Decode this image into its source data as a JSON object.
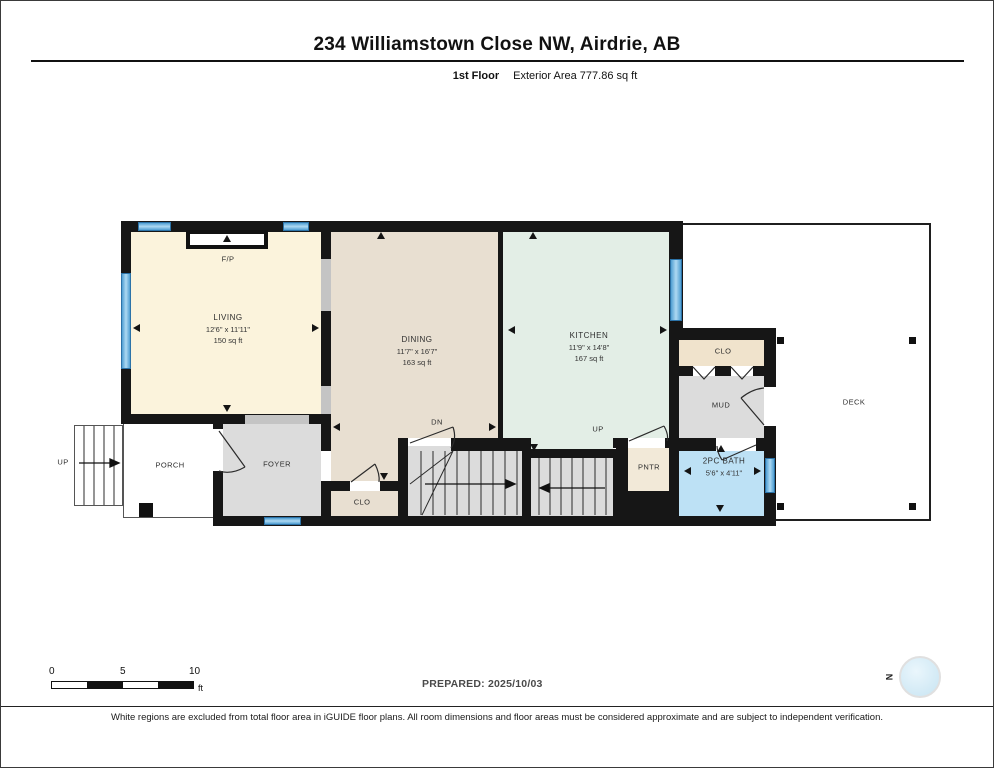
{
  "header": {
    "title": "234 Williamstown Close NW, Airdrie, AB",
    "floor_label": "1st Floor",
    "area_label": "Exterior Area 777.86 sq ft"
  },
  "rooms": {
    "living": {
      "name": "LIVING",
      "dims": "12'6\" x 11'11\"",
      "area": "150 sq ft"
    },
    "dining": {
      "name": "DINING",
      "dims": "11'7\" x 16'7\"",
      "area": "163 sq ft"
    },
    "kitchen": {
      "name": "KITCHEN",
      "dims": "11'9\" x 14'8\"",
      "area": "167 sq ft"
    },
    "bath": {
      "name": "2PC BATH",
      "dims": "5'6\" x 4'11\""
    },
    "clo_wing": {
      "name": "CLO"
    },
    "mud": {
      "name": "MUD"
    },
    "deck": {
      "name": "DECK"
    },
    "porch": {
      "name": "PORCH"
    },
    "foyer": {
      "name": "FOYER"
    },
    "clo_hall": {
      "name": "CLO"
    },
    "pantry": {
      "name": "PNTR"
    },
    "fireplace": {
      "label": "F/P"
    }
  },
  "stairs": {
    "exterior_up": "UP",
    "interior_up": "UP",
    "interior_down": "DN"
  },
  "scale_bar": {
    "ticks": [
      "0",
      "5",
      "10"
    ],
    "unit": "ft"
  },
  "prepared_label": "PREPARED: 2025/10/03",
  "compass": {
    "north": "N"
  },
  "footer": {
    "disclaimer": "White regions are excluded from total floor area in iGUIDE floor plans. All room dimensions and floor areas must be considered approximate and are subject to independent verification."
  },
  "colors": {
    "living": "#FBF3DC",
    "dining": "#E8DFD1",
    "kitchen": "#E3EEE6",
    "hall_gray": "#DCDCDC",
    "closet_tan": "#F0E3CC",
    "bath_blue": "#BDE1F5",
    "window_blue": "#5FA8D8",
    "wall": "#161616"
  }
}
